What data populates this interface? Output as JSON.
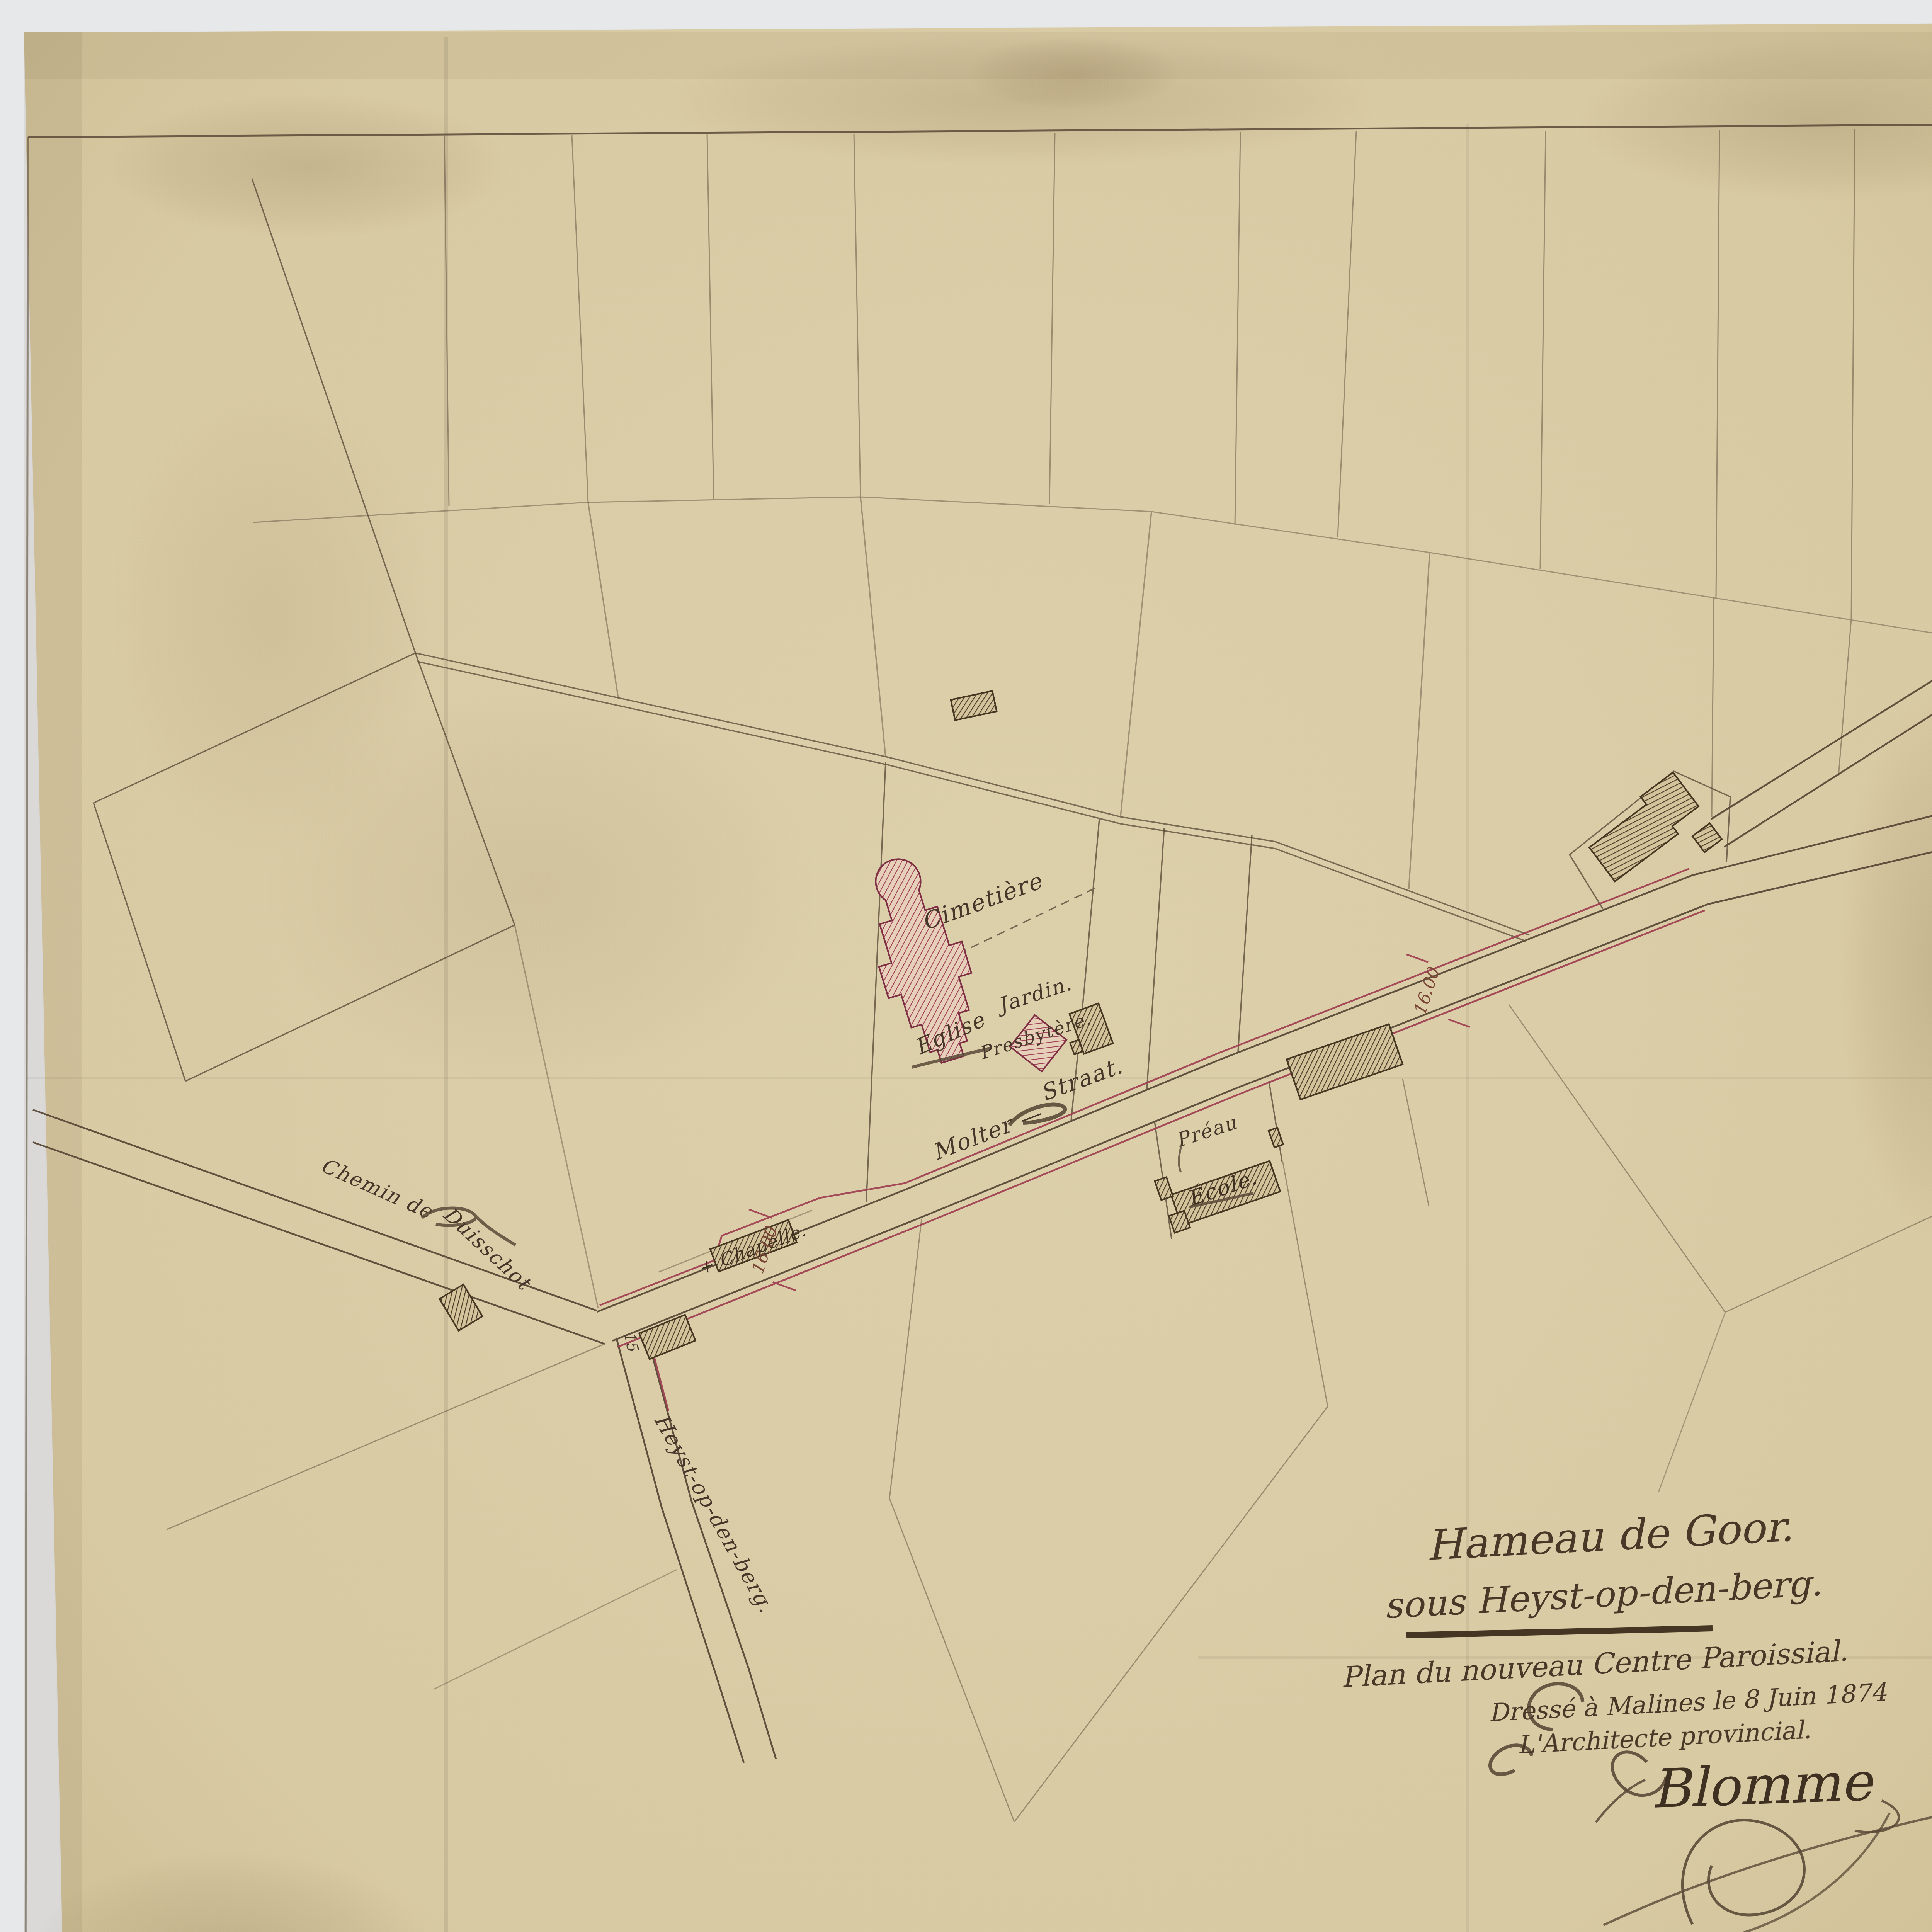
{
  "labels": {
    "cimetiere": "Cimeti\u00e8re",
    "jardin": "Jardin.",
    "eglise": "Eglise",
    "presbytere": "Presbyt\u00e8re.",
    "molter": "Molter \u2014",
    "straat": "Straat.",
    "preau": "Pr\u00e9au",
    "ecole": "\u00c9cole.",
    "chapelle": "+ Chapelle.",
    "chemin_de": "Chemin de",
    "duisschot": "Duisschot",
    "heyst_road": "Heyst-op-den-berg.",
    "dim_chapelle": "16.00",
    "dim_ecole": "16.00",
    "dim_junction": "15"
  },
  "title_block": {
    "line1": "Hameau de Goor.",
    "line2": "sous Heyst-op-den-berg.",
    "line3": "Plan du nouveau Centre Paroissial.",
    "line4": "Dress\u00e9 \u00e0 Malines le 8 Juin 1874",
    "line5": "L'Architecte provincial.",
    "signature": "Blomme"
  },
  "colors": {
    "paper": "#d8caa3",
    "background": "#e7e8ea",
    "ink": "#4a3b2a",
    "alignment_red": "#9e3b4f",
    "church_pink": "#a04055"
  }
}
